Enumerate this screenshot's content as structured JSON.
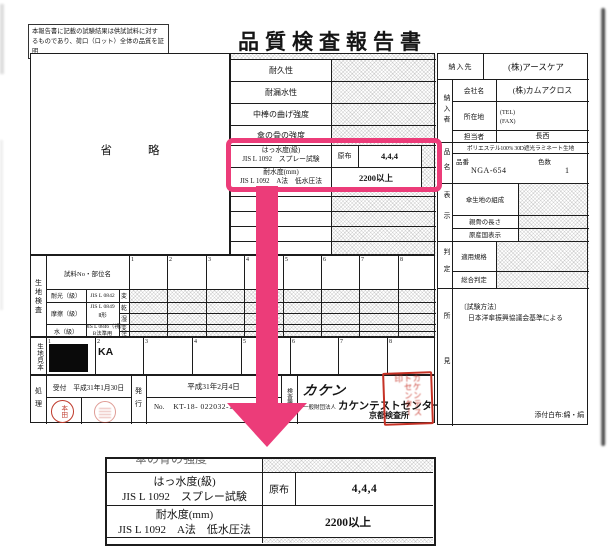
{
  "doc": {
    "disclaimer_l1": "本報告書に記載の試験結果は供試試料に対す",
    "disclaimer_l2": "るものであり、荷口（ロット）全体の品質を証明",
    "disclaimer_l3": "するものではありません。",
    "title": "品質検査報告書"
  },
  "left_box": {
    "omit_1": "省",
    "omit_2": "略"
  },
  "tests": {
    "rows": [
      "耐久性",
      "耐漏水性",
      "中棒の曲げ強度",
      "傘の骨の強度"
    ],
    "spray_l1": "はっ水度(級)",
    "spray_l2": "JIS L 1092　スプレー試験",
    "spray_sample": "原布",
    "spray_value": "4,4,4",
    "water_l1": "耐水度(mm)",
    "water_l2": "JIS L 1092　A法　低水圧法",
    "water_value": "2200以上"
  },
  "fabric": {
    "label": "生地検査",
    "header": "試料No・部位名",
    "cols": [
      "1",
      "2",
      "3",
      "4",
      "5",
      "6",
      "7",
      "8"
    ],
    "r1_name": "耐光（級）",
    "r1_method": "JIS L 0842",
    "r1_sub": "変",
    "r2_name": "摩擦（級）",
    "r2_method_l1": "JIS L 0849",
    "r2_method_l2": "Ⅱ形",
    "r2_sub1": "乾",
    "r2_sub2": "湿",
    "r3_name": "水（級）",
    "r3_method_l1": "JIS L 0846（視）",
    "r3_method_l2": "B法準用",
    "r3_sub1": "変",
    "r3_sub2": "汚"
  },
  "samples": {
    "label": "生地見本",
    "cols": [
      "1",
      "2",
      "3",
      "4",
      "5",
      "6",
      "7",
      "8"
    ],
    "cell2_text": "KA"
  },
  "process": {
    "label": "処理",
    "reception": "受付　平成31年1月30日",
    "stamp": "本田",
    "issue_label": "発行",
    "issue_date": "平成31年2月4日",
    "no_label": "No.",
    "no_value": "KT-18- 022032-1"
  },
  "agency": {
    "label": "検査機関",
    "logo": "カケン",
    "org_type": "一般財団法人",
    "org_name": "カケンテストセンター",
    "branch": "京都検査所",
    "seal_text": "カケンテストセンター印"
  },
  "right": {
    "supplier_label": "納入先",
    "supplier": "(株)アースケア",
    "deliverer_label": "納入者",
    "company_label": "会社名",
    "company": "(株)カムアクロス",
    "address_label": "所在地",
    "tel": "(TEL)",
    "fax": "(FAX)",
    "person_label": "担当者",
    "person": "長西",
    "product_label": "品名",
    "fabric_desc": "ポリエステル100% 30D遮光ラミネート生地",
    "item_no_label": "品番",
    "item_no": "NGA-654",
    "colors_label": "色数",
    "colors_value": "1",
    "display_label": "表示",
    "display_rows": [
      "傘生地の組成",
      "親骨の長さ",
      "原産国表示"
    ],
    "judgement_label": "判定",
    "judge_rows": [
      "適用規格",
      "総合判定"
    ],
    "findings_label": "所見",
    "method_title": "〔試験方法〕",
    "method_body": "日本洋傘振興協議会基準による",
    "attachment": "添付白布:綿・絹"
  },
  "zoom": {
    "prev_row": "傘の骨の強度",
    "spray_l1": "はっ水度(級)",
    "spray_l2": "JIS L 1092　スプレー試験",
    "spray_sample": "原布",
    "spray_value": "4,4,4",
    "water_l1": "耐水度(mm)",
    "water_l2": "JIS L 1092　A法　低水圧法",
    "water_value": "2200以上"
  },
  "colors": {
    "highlight": "#ec3c79",
    "stamp": "#bf3a2b",
    "seal": "#c63226"
  }
}
